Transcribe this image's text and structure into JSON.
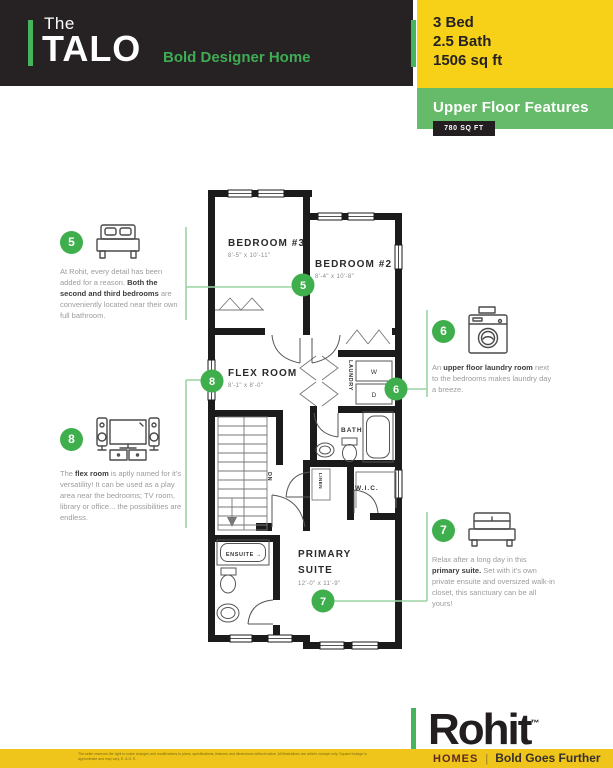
{
  "colors": {
    "dark": "#262122",
    "yellow": "#F6D117",
    "banner_green": "#66BB6A",
    "accent_green": "#46B45A",
    "callout_green": "#3FAE4C",
    "connector_green": "#9BD3A4",
    "homes_maroon": "#5E2823"
  },
  "header": {
    "brand_prefix": "The",
    "brand_name": "TALO",
    "tagline": "Bold Designer Home",
    "specs": [
      "3 Bed",
      "2.5 Bath",
      "1506 sq ft"
    ]
  },
  "features": {
    "title": "Upper Floor Features",
    "area": "780 SQ FT"
  },
  "plan": {
    "bedroom3": {
      "name": "BEDROOM #3",
      "dims": "8'-5\" x 10'-11\""
    },
    "bedroom2": {
      "name": "BEDROOM #2",
      "dims": "8'-4\" x 10'-8\""
    },
    "flex": {
      "name": "FLEX ROOM",
      "dims": "8'-1\" x 8'-0\""
    },
    "primary": {
      "line1": "PRIMARY",
      "line2": "SUITE",
      "dims": "12'-0\" x 11'-9\""
    },
    "bath": "BATH",
    "laundry": "LAUNDRY",
    "wic": "W.I.C.",
    "linen": "LINEN",
    "ensuite": "ENSUITE →",
    "washer": "W",
    "dryer": "D",
    "down": "DN"
  },
  "callouts": [
    {
      "number": "5",
      "icon": "bed-icon",
      "segments": [
        {
          "t": "At Rohit, every detail has been added for a reason. "
        },
        {
          "t": "Both the second and third bedrooms",
          "b": true
        },
        {
          "t": " are conveniently located near their own full bathroom."
        }
      ]
    },
    {
      "number": "8",
      "icon": "tv-speakers-icon",
      "segments": [
        {
          "t": "The "
        },
        {
          "t": "flex room",
          "b": true
        },
        {
          "t": " is aptly named for it's versatility! It can be used as a play area near the bedrooms; TV room, library or office... the possibilities are endless."
        }
      ]
    },
    {
      "number": "6",
      "icon": "washing-machine-icon",
      "segments": [
        {
          "t": "An "
        },
        {
          "t": "upper floor laundry room",
          "b": true
        },
        {
          "t": " next to the bedrooms makes laundry day a breeze."
        }
      ]
    },
    {
      "number": "7",
      "icon": "bed-icon",
      "segments": [
        {
          "t": "Relax after a long day in this "
        },
        {
          "t": "primary suite.",
          "b": true
        },
        {
          "t": " Set with it's own private ensuite and oversized walk-in closet, this sanctuary can be all yours!"
        }
      ]
    }
  ],
  "footer": {
    "brand": "Rohit",
    "trademark": "™",
    "sub_brand": "HOMES",
    "separator": "|",
    "tagline": "Bold Goes Further",
    "disclaimer": "The seller reserves the right to make changes and modifications to plans, specifications, features and dimensions without notice. All illustrations are artist's concept only. Square footage is approximate and may vary. E. & O. E."
  }
}
